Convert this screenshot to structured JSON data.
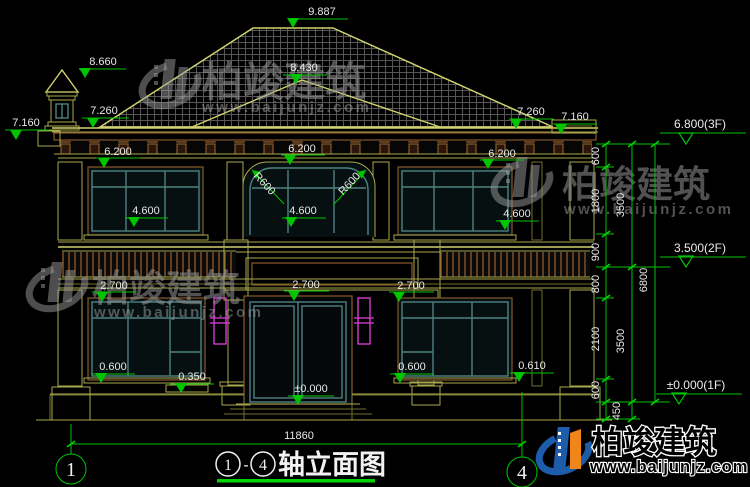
{
  "watermark": {
    "brand": "柏竣建筑",
    "url": "www.baijunjz.com"
  },
  "title": {
    "axis_from": "1",
    "separator": "-",
    "axis_to": "4",
    "name": "轴立面图"
  },
  "axes": {
    "left": "1",
    "right": "4",
    "total_width": "11860"
  },
  "levels": {
    "roof_ridge": "9.887",
    "chimney_top": "8.660",
    "hip_ridge": "8.430",
    "eave_left": "7.260",
    "eave_right": "7.260",
    "cornice_left": "7.160",
    "cornice_right": "7.160",
    "floor3": "6.800(3F)",
    "floor2": "3.500(2F)",
    "floor1": "±0.000(1F)",
    "zero": "±0.000"
  },
  "ann": {
    "w2f_head_l": "6.200",
    "w2f_head_c": "6.200",
    "w2f_head_r": "6.200",
    "w2f_sill_l": "4.600",
    "w2f_sill_c": "4.600",
    "w2f_sill_r": "4.600",
    "arch_r_l": "R600",
    "arch_r_r": "R600",
    "w1f_head_l": "2.700",
    "w1f_head_c": "2.700",
    "w1f_head_r": "2.700",
    "w1f_sill_l": "0.600",
    "w1f_sill_r": "0.600",
    "ledge": "0.350",
    "pedestal": "0.610"
  },
  "vdims": {
    "c1": [
      "600",
      "1800",
      "900",
      "800",
      "2100",
      "600",
      "450"
    ],
    "c2": [
      "3500",
      "3500"
    ],
    "c3": [
      "6800"
    ]
  },
  "colors": {
    "background": "#000000",
    "cad_line": "#a8a84e",
    "dimension_green": "#00c400",
    "window_frame": "#4e8282",
    "wood_brown": "#8a5a2a",
    "sconce_magenta": "#e040e0",
    "brand_blue": "#1d5cab",
    "brand_orange": "#f08519"
  }
}
